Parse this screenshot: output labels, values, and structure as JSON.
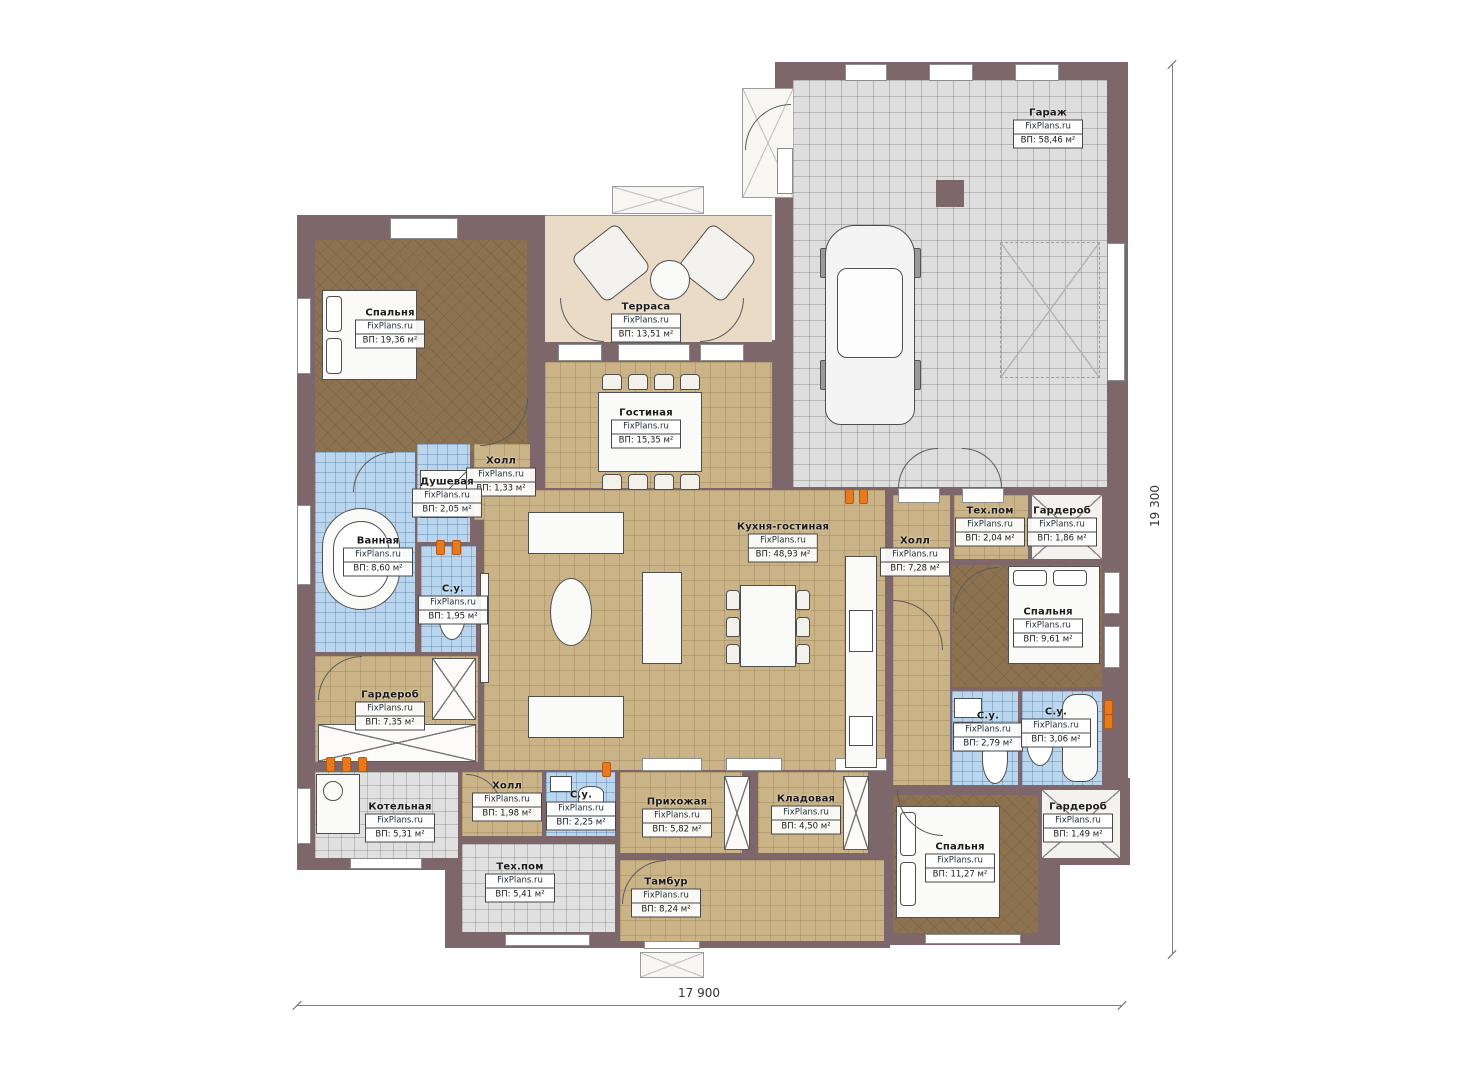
{
  "watermark": "FixPlans.ru",
  "rooms": [
    {
      "id": "bedroom-1",
      "name": "Спальня",
      "area": "ВП: 19,36 м²"
    },
    {
      "id": "terrace",
      "name": "Терраса",
      "area": "ВП: 13,51 м²"
    },
    {
      "id": "garage",
      "name": "Гараж",
      "area": "ВП: 58,46 м²"
    },
    {
      "id": "living",
      "name": "Гостиная",
      "area": "ВП: 15,35 м²"
    },
    {
      "id": "hall-small",
      "name": "Холл",
      "area": "ВП: 1,33 м²"
    },
    {
      "id": "shower",
      "name": "Душевая",
      "area": "ВП: 2,05 м²"
    },
    {
      "id": "bathroom",
      "name": "Ванная",
      "area": "ВП: 8,60 м²"
    },
    {
      "id": "wc-195",
      "name": "С.у.",
      "area": "ВП: 1,95 м²"
    },
    {
      "id": "wardrobe-735",
      "name": "Гардероб",
      "area": "ВП: 7,35 м²"
    },
    {
      "id": "kitchen-living",
      "name": "Кухня-гостиная",
      "area": "ВП: 48,93 м²"
    },
    {
      "id": "hall-728",
      "name": "Холл",
      "area": "ВП: 7,28 м²"
    },
    {
      "id": "tech-204",
      "name": "Тех.пом",
      "area": "ВП: 2,04 м²"
    },
    {
      "id": "wardrobe-186",
      "name": "Гардероб",
      "area": "ВП: 1,86 м²"
    },
    {
      "id": "bedroom-961",
      "name": "Спальня",
      "area": "ВП: 9,61 м²"
    },
    {
      "id": "wc-279",
      "name": "С.у.",
      "area": "ВП: 2,79 м²"
    },
    {
      "id": "wc-306",
      "name": "С.у.",
      "area": "ВП: 3,06 м²"
    },
    {
      "id": "wardrobe-149",
      "name": "Гардероб",
      "area": "ВП: 1,49 м²"
    },
    {
      "id": "bedroom-1127",
      "name": "Спальня",
      "area": "ВП: 11,27 м²"
    },
    {
      "id": "boiler-room",
      "name": "Котельная",
      "area": "ВП: 5,31 м²"
    },
    {
      "id": "hall-198",
      "name": "Холл",
      "area": "ВП: 1,98 м²"
    },
    {
      "id": "wc-225",
      "name": "С.у.",
      "area": "ВП: 2,25 м²"
    },
    {
      "id": "tech-541",
      "name": "Тех.пом",
      "area": "ВП: 5,41 м²"
    },
    {
      "id": "entry-582",
      "name": "Прихожая",
      "area": "ВП: 5,82 м²"
    },
    {
      "id": "storage",
      "name": "Кладовая",
      "area": "ВП: 4,50 м²"
    },
    {
      "id": "tambour",
      "name": "Тамбур",
      "area": "ВП: 8,24 м²"
    }
  ],
  "dimensions": {
    "width": "17 900",
    "height": "19 300"
  }
}
